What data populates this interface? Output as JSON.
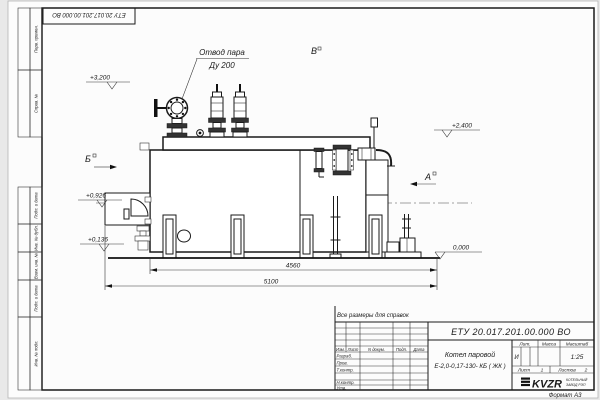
{
  "stamp_top": {
    "doc_number": "ЕТУ 20.017.201.00.000  ВО"
  },
  "frame": {
    "left_labels": [
      "Перв. примен.",
      "Справ. №",
      "Подп. и дата",
      "Инв. № дубл.",
      "Взам. инв. №",
      "Подп. и дата",
      "Инв. № подл."
    ],
    "format_note": "Формат А3"
  },
  "drawing": {
    "callout": {
      "line1": "Отвод пара",
      "line2": "Ду 200"
    },
    "views": {
      "b": "Б",
      "v": "В",
      "a": "А"
    },
    "elevations": {
      "e1": "+3,200",
      "e2": "+2,400",
      "e3": "+0,926",
      "e4": "+0,136",
      "e5": "0,000"
    },
    "dimensions": {
      "inner": "4560",
      "outer": "5100"
    }
  },
  "title_block": {
    "note": "Все размеры для справок",
    "doc_number": "ЕТУ 20.017.201.00.000  ВО",
    "product_line1": "Котел паровой",
    "product_line2": "Е-2,0-0,17-130- КБ ( ЖК )",
    "header_cols": [
      "Изм.",
      "Лист",
      "N докум.",
      "Подп.",
      "Дата"
    ],
    "sig_rows": [
      "Разраб.",
      "Пров.",
      "Т.контр.",
      "Н.контр.",
      "Утв."
    ],
    "lit_header": "Лит.",
    "mass_header": "Масса",
    "scale_header": "Масштаб",
    "lit_value": "И",
    "scale_value": "1:25",
    "sheet_label": "Лист",
    "sheet_value": "1",
    "sheets_label": "Листов",
    "sheets_value": "2",
    "logo": {
      "text": "KVZR",
      "caption1": "КОТЕЛЬНЫЙ",
      "caption2": "ЗАВОД РЭП"
    }
  }
}
